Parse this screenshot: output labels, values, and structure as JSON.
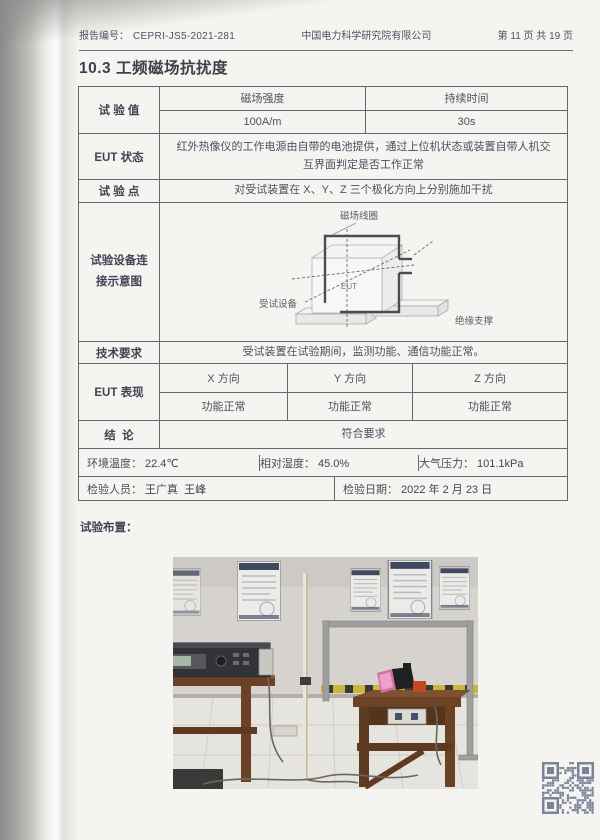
{
  "doc": {
    "header": {
      "report_no_label": "报告编号：",
      "report_no": "CEPRI-JS5-2021-281",
      "company": "中国电力科学研究院有限公司",
      "page_info": "第 11 页 共 19 页"
    },
    "section_title": "10.3 工频磁场抗扰度"
  },
  "table": {
    "test_value": {
      "label": "试 验 值",
      "headers": [
        "磁场强度",
        "持续时间"
      ],
      "values": [
        "100A/m",
        "30s"
      ]
    },
    "eut_state": {
      "label": "EUT 状态",
      "value": "红外热像仪的工作电源由自带的电池提供，通过上位机状态或装置自带人机交互界面判定是否工作正常"
    },
    "test_point": {
      "label": "试 验 点",
      "value": "对受试装置在 X、Y、Z 三个极化方向上分别施加干扰"
    },
    "setup": {
      "label": "试验设备连接示意图",
      "diagram": {
        "coil": "磁场线圈",
        "eut": "EUT",
        "device": "受试设备",
        "support": "绝缘支撑"
      }
    },
    "tech_req": {
      "label": "技术要求",
      "value": "受试装置在试验期间，监测功能、通信功能正常。"
    },
    "eut_perf": {
      "label": "EUT 表现",
      "directions": [
        "X 方向",
        "Y 方向",
        "Z 方向"
      ],
      "results": [
        "功能正常",
        "功能正常",
        "功能正常"
      ]
    },
    "conclusion": {
      "label": "结  论",
      "value": "符合要求"
    },
    "environment": {
      "temp_label": "环境温度：",
      "temp_value": "22.4℃",
      "humidity_label": "相对湿度：",
      "humidity_value": "45.0%",
      "pressure_label": "大气压力：",
      "pressure_value": "101.1kPa"
    },
    "inspection": {
      "people_label": "检验人员：",
      "people": "王广真  王峰",
      "date_label": "检验日期：",
      "date": "2022 年 2 月 23 日"
    }
  },
  "footer": {
    "arrangement_label": "试验布置："
  },
  "colors": {
    "paper": "#f6f4f1",
    "ink": "#4a505e",
    "table_border": "#61666f",
    "qr": "#5e6c85"
  }
}
